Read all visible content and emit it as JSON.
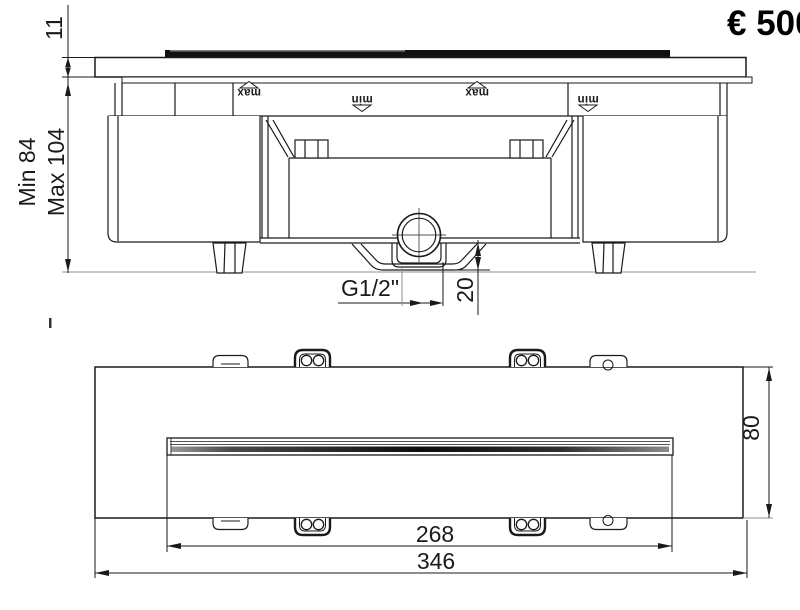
{
  "price": {
    "label": "€ 500"
  },
  "front_view": {
    "dims": {
      "plate_thickness": "11",
      "install_depth_min": "Min 84",
      "install_depth_max": "Max 104",
      "outlet_thread": "G1/2\"",
      "outlet_offset": "20"
    },
    "level_markers": [
      {
        "label": "max"
      },
      {
        "label": "min"
      },
      {
        "label": "max"
      },
      {
        "label": "min"
      }
    ]
  },
  "plan_view": {
    "dims": {
      "slot_length": "268",
      "overall_length": "346",
      "overall_depth": "80"
    }
  },
  "colors": {
    "line": "#1a1a1a",
    "datum": "#909090",
    "slot_fill": "#111111"
  }
}
